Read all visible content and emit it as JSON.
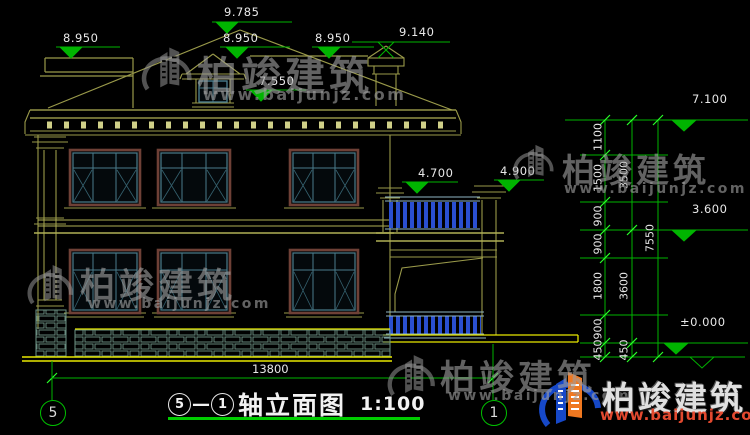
{
  "colors": {
    "background": "#000000",
    "wall_line": "#9a9a4a",
    "bright_line": "#e8e800",
    "dentil": "#cfcf88",
    "window_outer": "#6e4036",
    "window_inner": "#4a7c8c",
    "baluster_blue": "#2a4fd0",
    "dim_green": "#00b400",
    "tick_green": "#2aff2a",
    "text_white": "#e8e8e8",
    "stone": "#6e9486",
    "logo_blue": "#1648c8",
    "logo_orange": "#f07820",
    "wm_url_red": "#e2492f"
  },
  "elevation_marks": {
    "peak": "9.785",
    "ridge_left": "8.950",
    "ridge_mid": "8.950",
    "ridge_right": "8.950",
    "chimney": "9.140",
    "dormer_sill": "7.550",
    "balcony_rail": "4.700",
    "porch_capital": "4.900",
    "eave_right": "7.100",
    "floor2_right": "3.600",
    "ground_right": "±0.000"
  },
  "right_dim_chains": {
    "inner": [
      "1100",
      "1500",
      "900",
      "900",
      "1800",
      "900",
      "450"
    ],
    "middle": [
      "3500",
      "3600",
      "450"
    ],
    "outer": [
      "7550"
    ]
  },
  "bottom_dim": {
    "overall_width": "13800"
  },
  "axis_bubbles": {
    "left": "5",
    "right": "1"
  },
  "title_block": {
    "axis_from": "5",
    "dash": "—",
    "axis_to": "1",
    "name": "轴立面图",
    "scale": "1:100"
  },
  "watermark": {
    "company": "柏竣建筑",
    "url": "www.baijunjz.com"
  }
}
